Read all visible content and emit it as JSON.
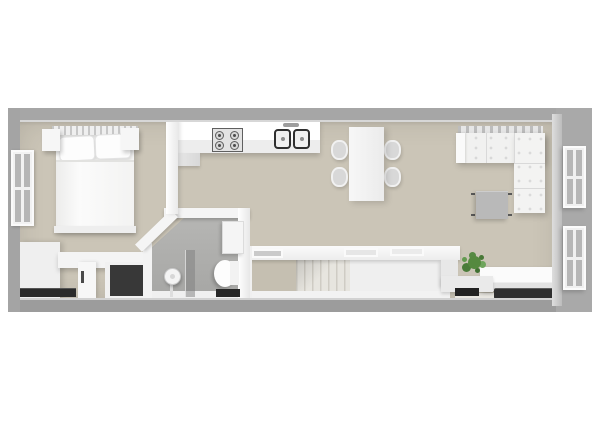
{
  "scene": {
    "type": "3d-floor-plan-render",
    "view": "top-down",
    "rooms": [
      {
        "name": "bedroom",
        "items": [
          "double-bed",
          "two-pillows",
          "headboard",
          "nightstand-left",
          "nightstand-right",
          "left-window",
          "desk-cabinet-unit",
          "dark-closet-recess",
          "floor-vent"
        ]
      },
      {
        "name": "bathroom",
        "items": [
          "shower-head",
          "glass-screen",
          "toilet",
          "wall-cabinet",
          "bath-mat",
          "angled-wall"
        ]
      },
      {
        "name": "kitchen",
        "items": [
          "wall-counter",
          "gas-hob-4-burners",
          "double-sink",
          "faucet"
        ]
      },
      {
        "name": "dining-area",
        "items": [
          "rectangular-table",
          "chair",
          "chair",
          "chair",
          "chair"
        ]
      },
      {
        "name": "living-area",
        "items": [
          "corner-sofa",
          "coffee-table",
          "tv-console",
          "flat-tv",
          "potted-plant",
          "right-window-upper",
          "right-window-lower"
        ]
      },
      {
        "name": "stairwell",
        "items": [
          "half-wall-with-trays",
          "staircase",
          "landing"
        ]
      }
    ]
  },
  "palette": {
    "background": "#ffffff",
    "outer_wall": "#a6a6a6",
    "outer_wall_bottom": "#9c9c9c",
    "outer_wall_left": "#a4a4a4",
    "outer_wall_right": "#a9a9a9",
    "inner_wall": "#f4f4f4",
    "floor_main": "#cbc5b7",
    "floor_bathroom": "#aeaeac",
    "floor_landing": "#c5bfb1",
    "furniture_white": "#f2f2f2",
    "closet_dark": "#383838",
    "vent_dark": "#2b2b2b",
    "bath_mat_dark": "#262626",
    "tv_black": "#2f2f2f",
    "plant_green": "#55893f",
    "glass": "rgba(125,125,125,0.5)",
    "coffee_table_gray": "#b9b9b9",
    "window_pane": "#b6b6b6",
    "chair_gray": "#d8d8d8"
  }
}
